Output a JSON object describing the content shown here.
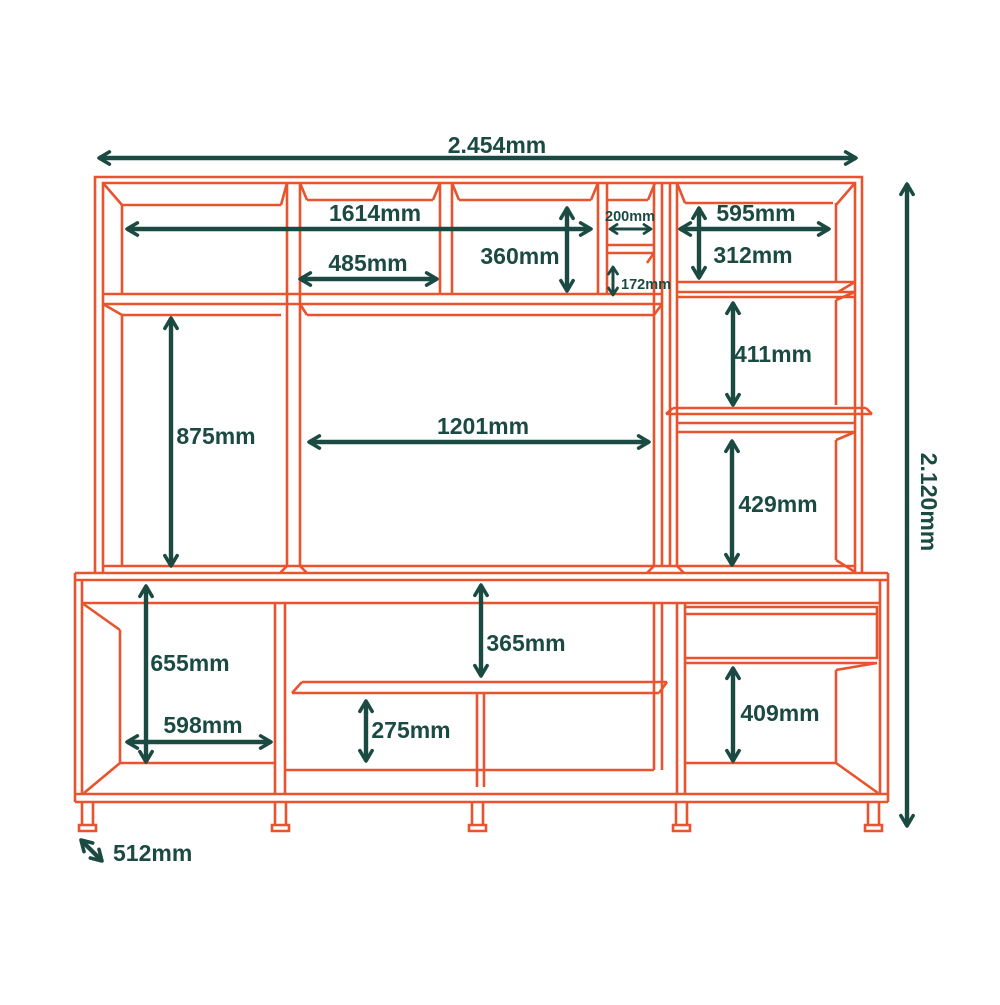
{
  "diagram": {
    "type": "furniture-dimension-drawing",
    "unit": "mm",
    "colors": {
      "structure": "#E9532D",
      "dimension": "#1B4A42",
      "background": "#FFFFFF"
    }
  },
  "dims": {
    "overall_width": "2.454mm",
    "overall_height": "2.120mm",
    "depth": "512mm",
    "top_shelf_span": "1614mm",
    "top_center_width": "485mm",
    "top_center_height": "360mm",
    "niche_width": "200mm",
    "niche_height": "172mm",
    "top_right_width": "595mm",
    "top_right_height": "312mm",
    "left_column_height": "875mm",
    "tv_opening_width": "1201mm",
    "right_upper_height": "411mm",
    "right_lower_height": "429mm",
    "base_left_height": "655mm",
    "base_left_width": "598mm",
    "base_center_height": "365mm",
    "base_shelf_height": "275mm",
    "base_right_height": "409mm"
  }
}
